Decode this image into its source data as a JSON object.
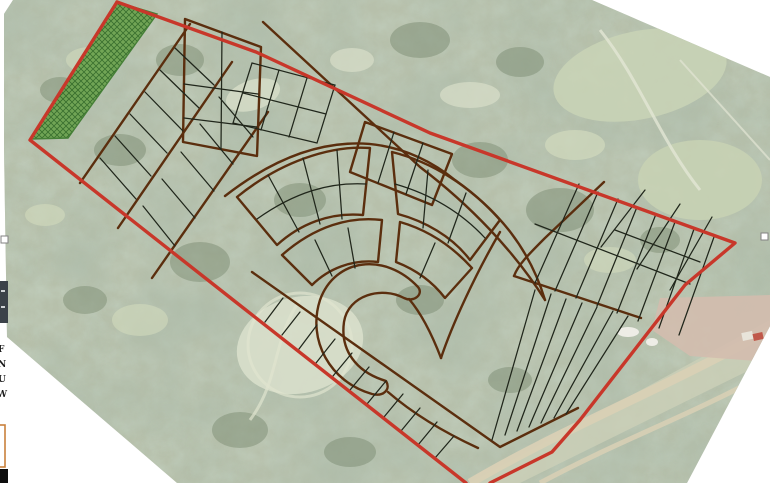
{
  "canvas": {
    "background": "#ffffff"
  },
  "plan": {
    "boundary_color": "#c8372a",
    "road_color": "#5b2e0e",
    "lot_line_color": "#20261b",
    "green_fill": "#6ba24e",
    "green_hatch": "#2e6823",
    "green_outline": "#3c7a2d"
  },
  "basemap": {
    "base": "#b7c0ab",
    "canopy": "#8a9a84",
    "clearing": "#dbe1cc",
    "field": "#c9d3b6",
    "dirt_road": "#d9d0b5",
    "bare_soil": "#d3bcae",
    "roof": "#c0584a"
  },
  "selection": {
    "handle_fill": "#ffffff",
    "handle_border": "#828282"
  },
  "left_margin": {
    "fragments": [
      "F",
      "N",
      "U",
      "W"
    ],
    "dark_block_color": "#3b4249",
    "orange_box_color": "#c9803c",
    "black_bar_color": "#0d0d0d"
  }
}
